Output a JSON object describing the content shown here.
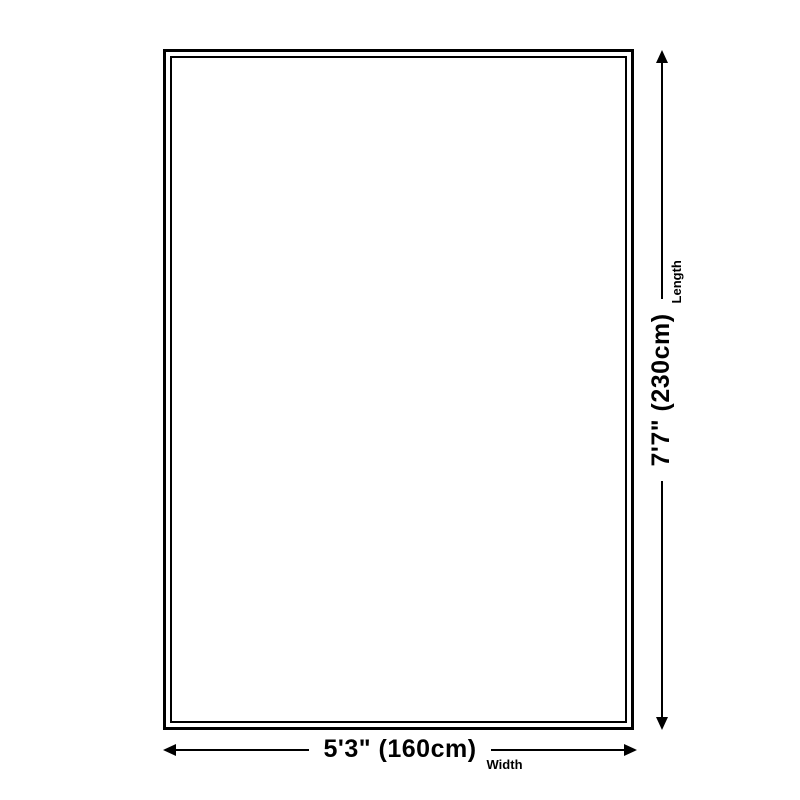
{
  "diagram": {
    "type": "product-dimensions",
    "shape": "rectangle-double-border",
    "colors": {
      "background": "#ffffff",
      "line": "#000000",
      "text": "#000000"
    }
  },
  "dims": {
    "width": {
      "size": "5'3\" (160cm)",
      "axis": "Width"
    },
    "length": {
      "size": "7'7\" (230cm)",
      "axis": "Length"
    }
  }
}
